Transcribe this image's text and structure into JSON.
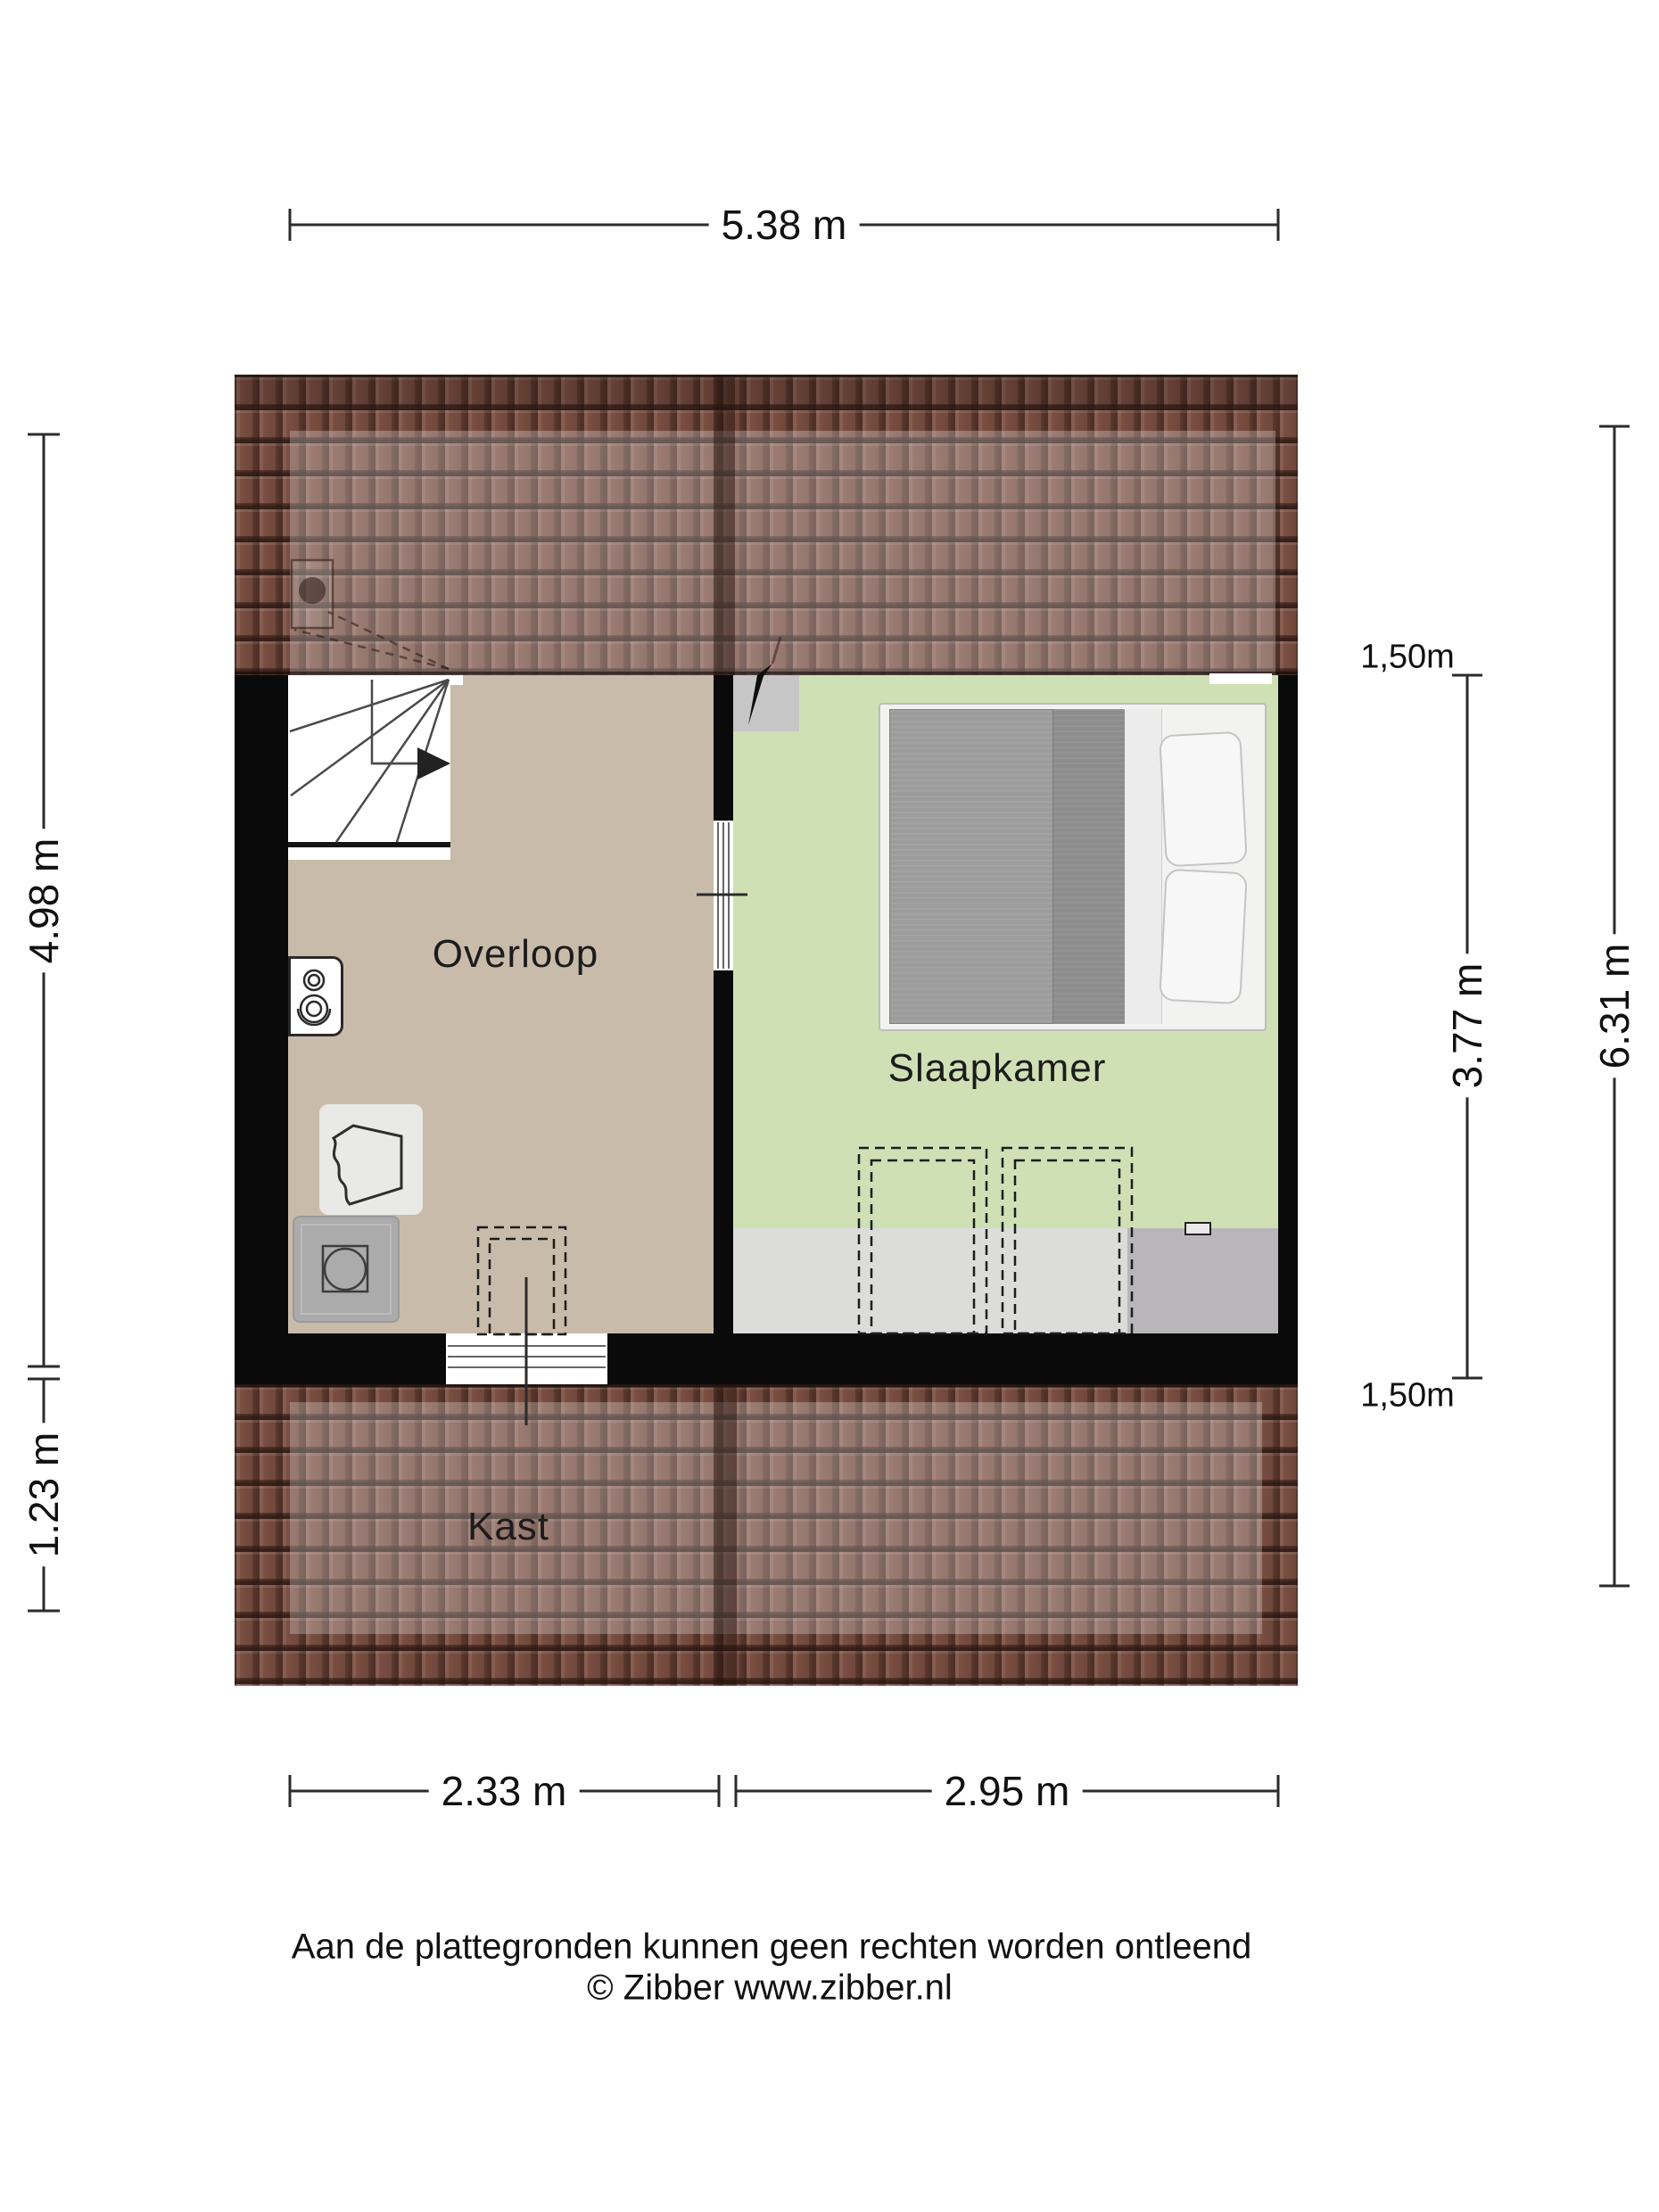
{
  "plan": {
    "rooms": [
      {
        "id": "overloop",
        "label": "Overloop"
      },
      {
        "id": "slaapkamer",
        "label": "Slaapkamer"
      },
      {
        "id": "kast",
        "label": "Kast"
      }
    ]
  },
  "dimensions": {
    "top_width": "5.38 m",
    "left_upper": "4.98 m",
    "left_lower": "1.23 m",
    "right_height_marker_top": "1,50m",
    "right_room_depth": "3.77 m",
    "right_height_marker_bottom": "1,50m",
    "right_total_depth": "6.31 m",
    "bottom_left_width": "2.33 m",
    "bottom_right_width": "2.95 m"
  },
  "footer": {
    "disclaimer": "Aan de plattegronden kunnen geen rechten worden ontleend",
    "credit": "© Zibber www.zibber.nl"
  },
  "colors": {
    "roof_base": "#7b4f42",
    "overloop_floor": "#c8bbaa",
    "bedroom_floor": "#cfe0b5",
    "low_ceiling_strip_light": "#dcdcdb",
    "low_ceiling_strip_dark": "#b8b6b8",
    "wall": "#0a0a0a"
  }
}
